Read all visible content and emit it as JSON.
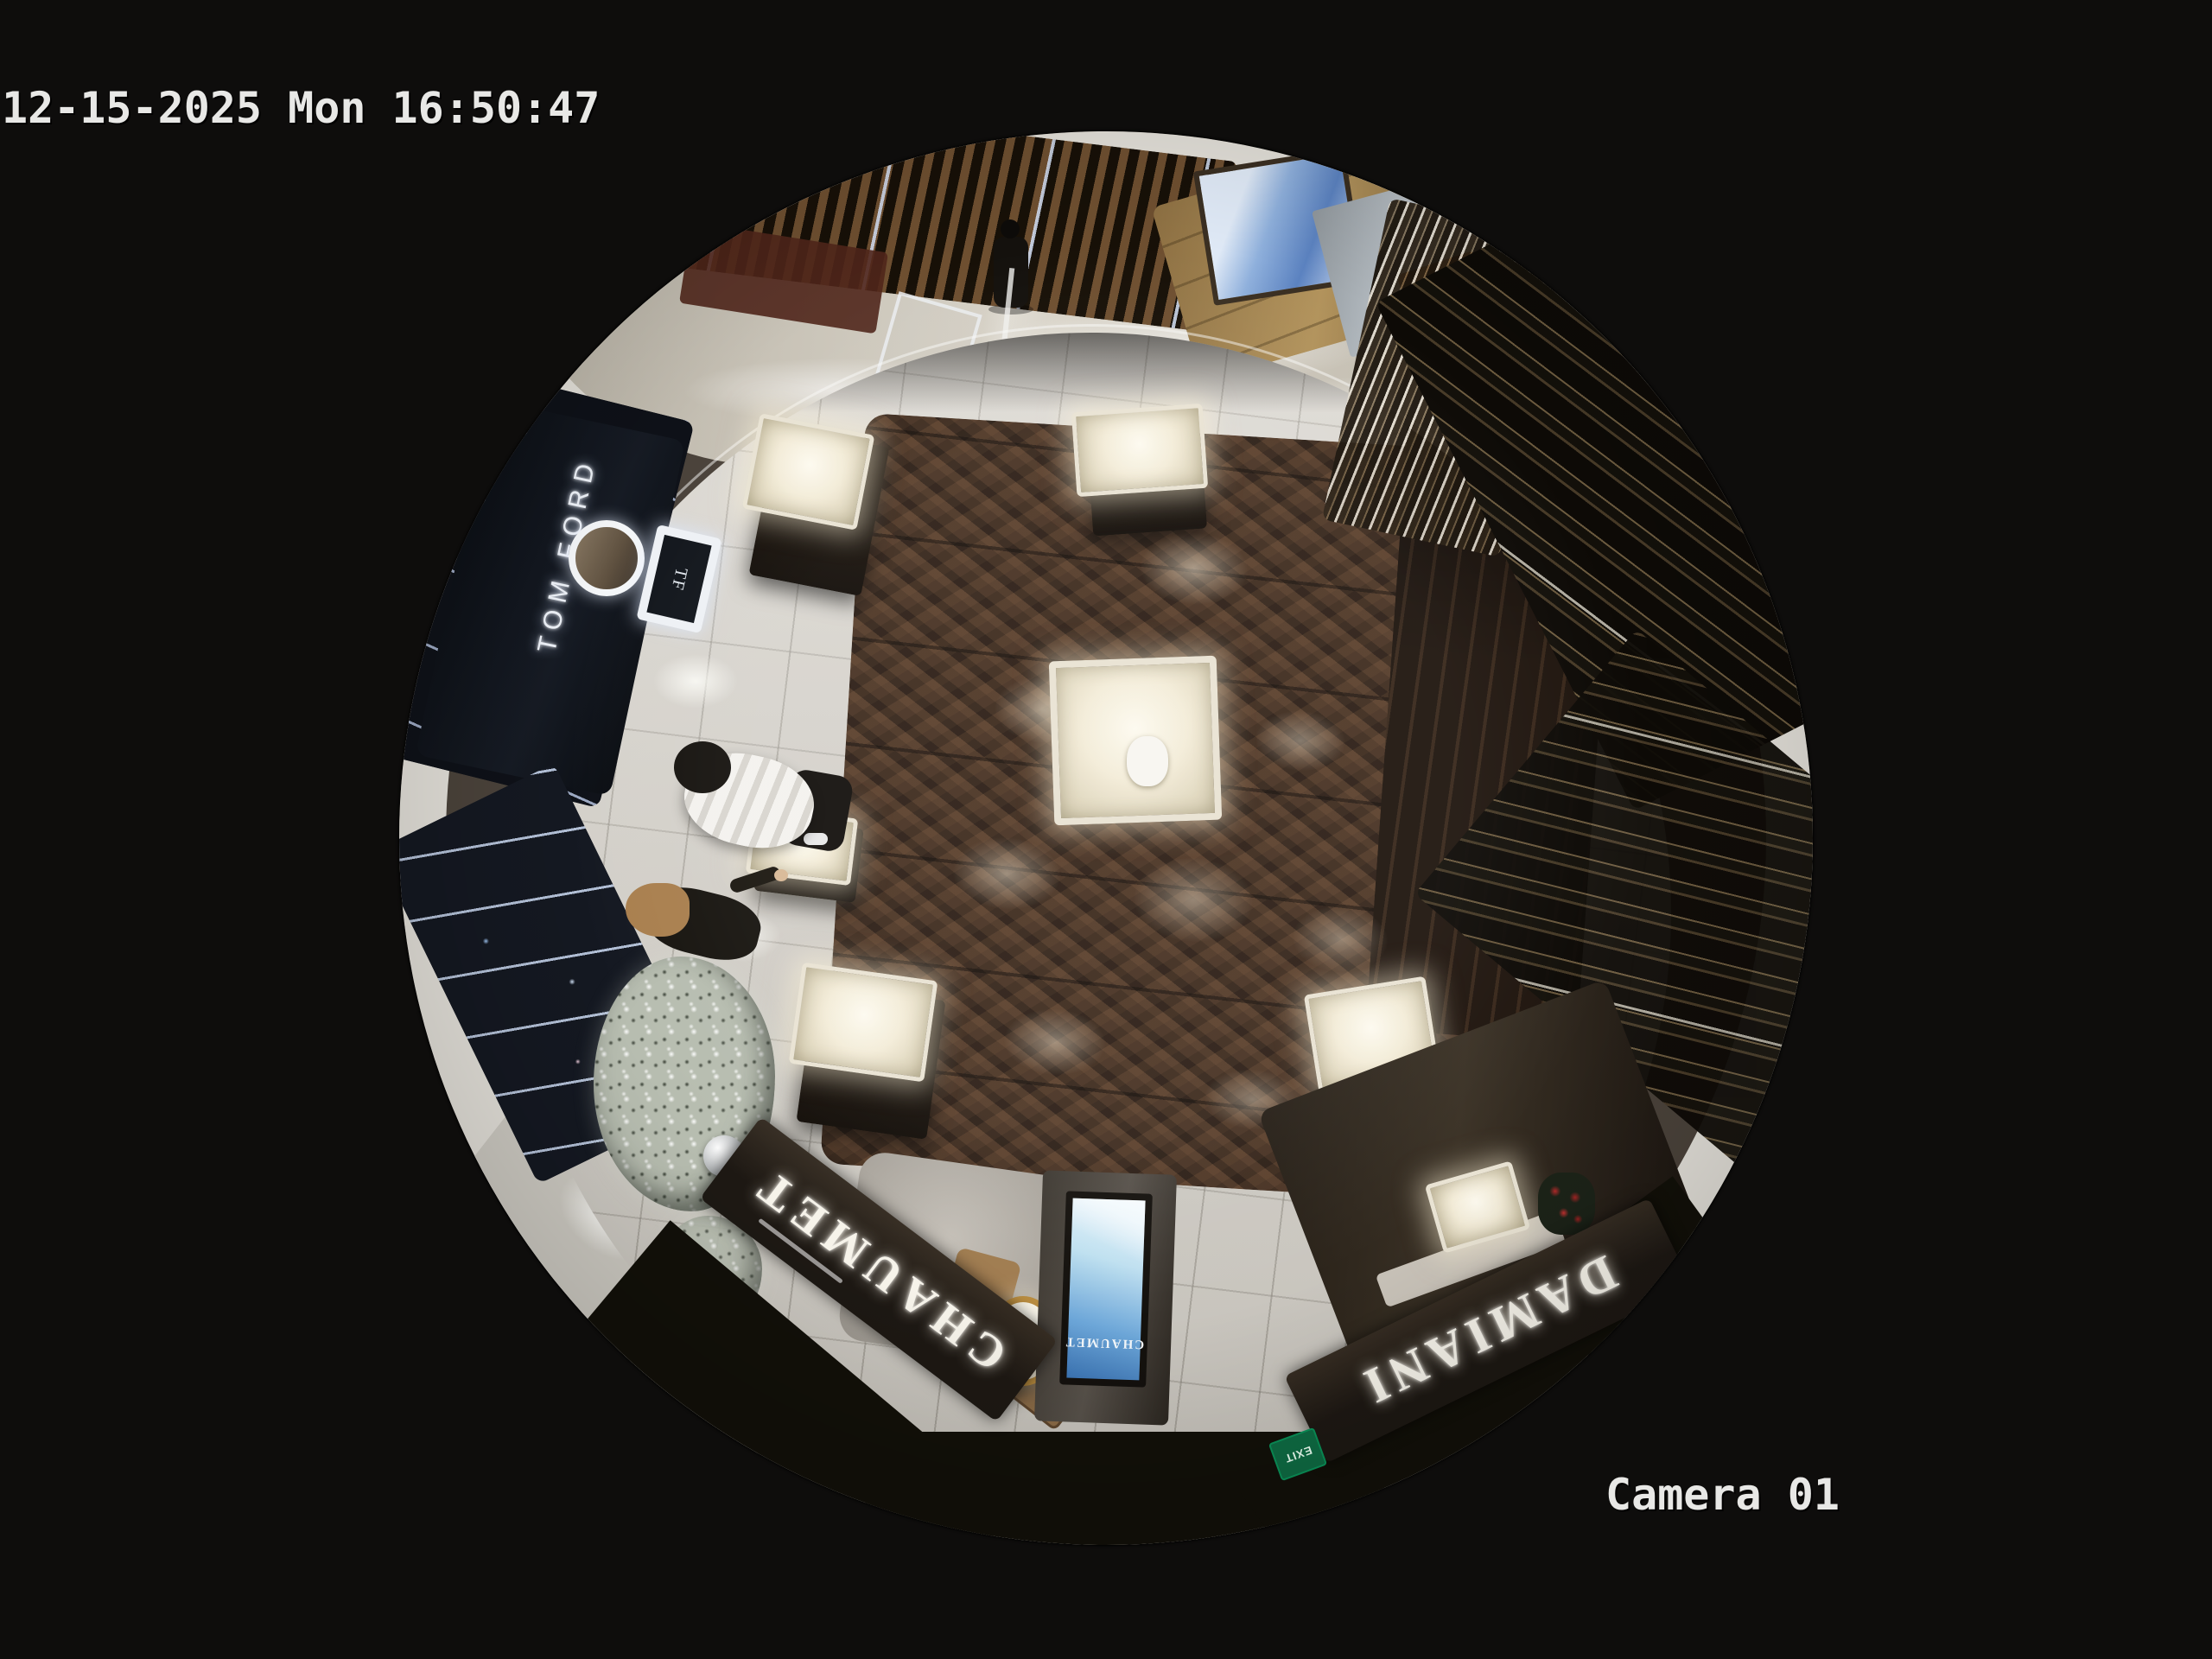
{
  "osd": {
    "timestamp": "12-15-2025 Mon 16:50:47",
    "camera_label": "Camera 01"
  },
  "signs": {
    "chaumet": "CHAUMET",
    "damiani": "DAMIANI",
    "tom_ford": "TOM FORD",
    "tf_monogram": "TF",
    "screen_brand": "CHAUMET",
    "exit": "EXIT"
  },
  "colors": {
    "background": "#0e0d0c",
    "osd_text": "#e8e8e6",
    "wood_floor": "#3c2b1f",
    "tile_floor": "#d5d1c9",
    "marble_corridor": "#c9c3b7",
    "ceiling_ring": "#e2dfd8",
    "gold_fascia": "#97784a",
    "fascia_dark": "#27211a",
    "screen_blue": "#4f86c6",
    "exit_green": "#0e6b43",
    "tree": "#b7bdb0"
  }
}
